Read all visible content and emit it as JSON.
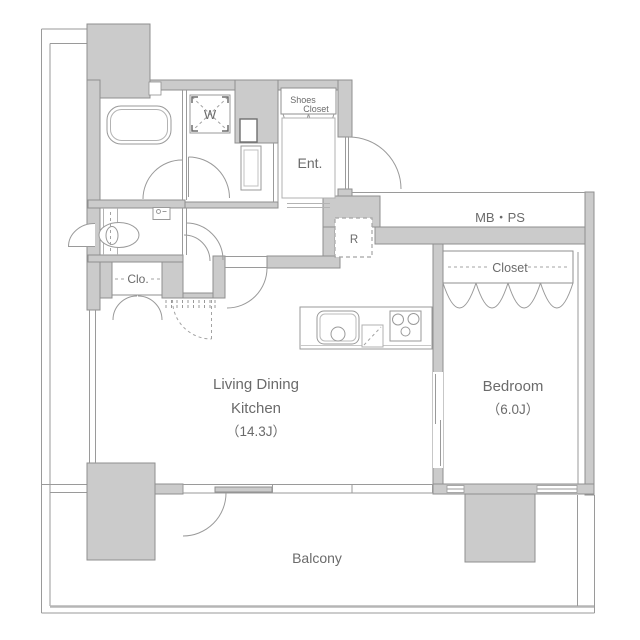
{
  "floorplan": {
    "labels": {
      "living_dining": "Living Dining",
      "kitchen": "Kitchen",
      "ldk_area": "（14.3J）",
      "bedroom": "Bedroom",
      "bedroom_area": "（6.0J）",
      "balcony": "Balcony",
      "entrance": "Ent.",
      "meter_box_pipe_space": "MB・PS",
      "bedroom_closet": "Closet",
      "hall_closet": "Clo.",
      "shoes_closet_line1": "Shoes",
      "shoes_closet_line2": "Closet",
      "washing_machine": "W",
      "refrigerator": "R"
    },
    "colors": {
      "wall_fill": "#cbcbcb",
      "wall_outline": "#8f8f8f",
      "line": "#9a9a9a",
      "text": "#6b6b6b",
      "background": "#ffffff"
    }
  }
}
